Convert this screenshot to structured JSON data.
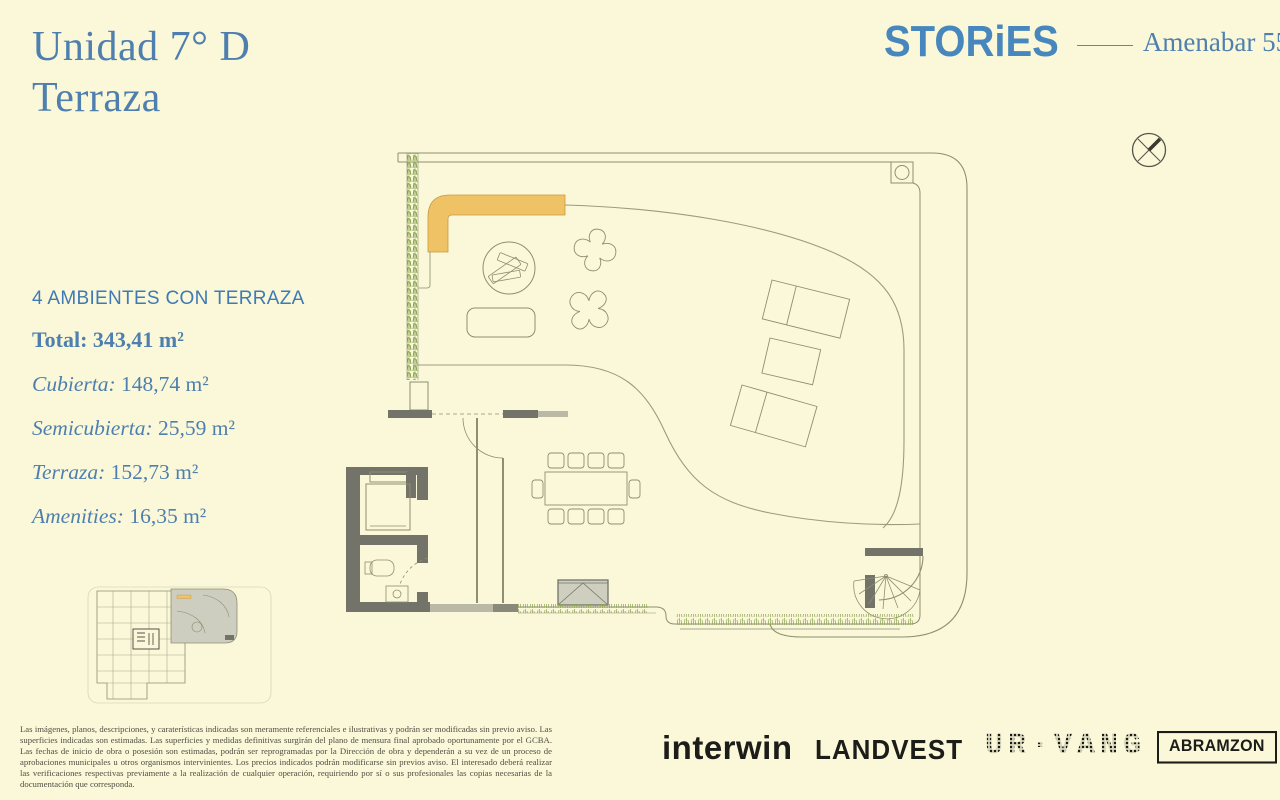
{
  "colors": {
    "background": "#FAF8D9",
    "title_blue": "#4E7FAE",
    "logo_blue": "#4887BD",
    "ink_black": "#1C1C18",
    "plan_line": "#8E8E70",
    "wall_dark": "#73736A",
    "pergola_orange": "#EFC266",
    "greenery_green": "#8CA353",
    "disclaimer_gray": "#4F4F42"
  },
  "header": {
    "title_line1": "Unidad 7° D",
    "title_line2": "Terraza",
    "brand": "STORiES",
    "project": "Amenabar 555"
  },
  "specs": {
    "headline": "4 AMBIENTES CON TERRAZA",
    "total_label": "Total:",
    "total_value": "343,41 m²",
    "items": [
      {
        "label": "Cubierta:",
        "value": "148,74 m²"
      },
      {
        "label": "Semicubierta:",
        "value": "25,59 m²"
      },
      {
        "label": "Terraza:",
        "value": "152,73 m²"
      },
      {
        "label": "Amenities:",
        "value": "16,35 m²"
      }
    ]
  },
  "floor_plan": {
    "elements": [
      "terrace-outline",
      "hedge",
      "pergola",
      "lounge-circle",
      "planter-stars",
      "bench",
      "sun-loungers",
      "dining-table-10-seats",
      "awning",
      "spiral-staircase",
      "elevator",
      "bathroom",
      "lawn-strips",
      "corner-column"
    ]
  },
  "key_plan": {
    "elements": [
      "building-floor-plate",
      "highlighted-unit"
    ]
  },
  "compass": {
    "meaning": "north-indicator"
  },
  "disclaimer": "Las imágenes, planos, descripciones, y caraterísticas indicadas son meramente referenciales e ilustrativas y podrán ser modificadas sin previo aviso. Las superficies indicadas son estimadas. Las superficies y medidas definitivas surgirán del plano de mensura final aprobado oportunamente por el GCBA. Las fechas de inicio de obra o posesión son estimadas, podrán ser reprogramadas por la Dirección de obra y dependerán a su vez de un proceso de aprobaciones municipales u otros organismos intervinientes. Los precios indicados podrán modificarse sin previos aviso. El interesado deberá realizar las verificaciones respectivas previamente a la realización de cualquier operación, requiriendo por sí o sus profesionales las copias necesarias de la documentación que corresponda.",
  "footer": {
    "logos": [
      {
        "name": "interwin",
        "text": "interwin"
      },
      {
        "name": "landvest",
        "text": "LANDVEST"
      },
      {
        "name": "urvang",
        "text": "UR·VANG"
      },
      {
        "name": "abramzon",
        "text": "ABRAMZON"
      }
    ]
  }
}
